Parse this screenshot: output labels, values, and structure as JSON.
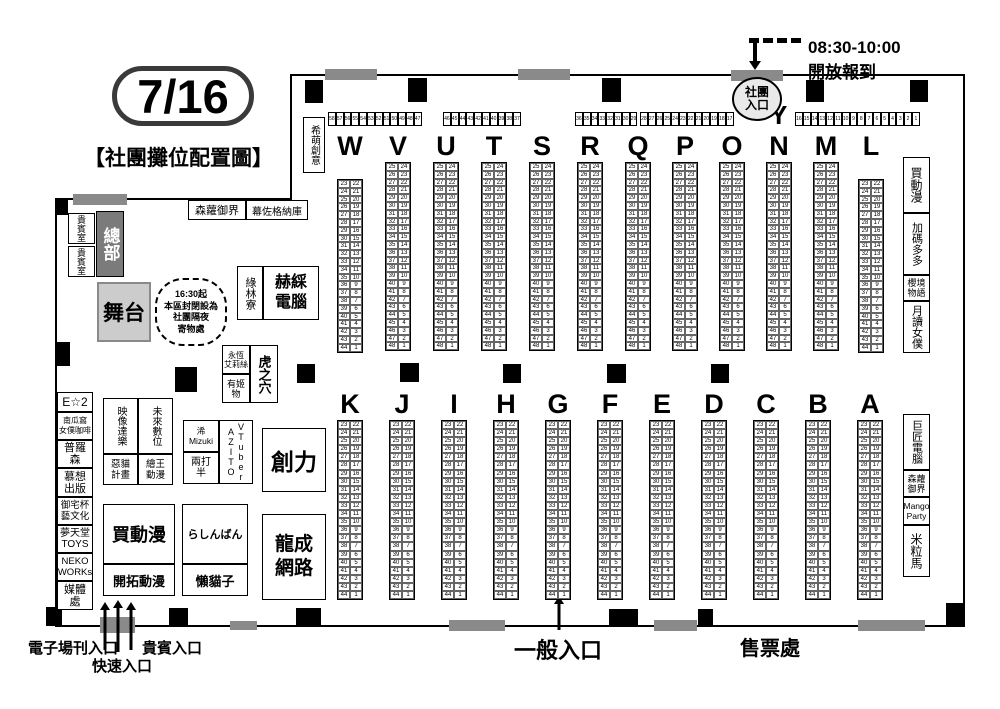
{
  "header": {
    "date": "7/16",
    "title": "【社團攤位配置圖】"
  },
  "notices": {
    "checkin_time": "08:30-10:00",
    "checkin_text": "開放報到"
  },
  "entrances": {
    "club": "社團\n入口",
    "general": "一般入口",
    "fast": "快速入口",
    "vip": "貴賓入口",
    "ezine": "電子場刊入口",
    "ticket": "售票處"
  },
  "booths": {
    "y_row": {
      "label": "Y",
      "segments": [
        {
          "from": 58,
          "to": 47
        },
        {
          "from": 46,
          "to": 37
        },
        {
          "from": 36,
          "to": 29
        },
        {
          "from": 28,
          "to": 17
        },
        {
          "from": 16,
          "to": 1
        }
      ]
    },
    "top_rows": [
      {
        "letter": "W",
        "left_from": 23,
        "left_to": 44,
        "right_from": 22
      },
      {
        "letter": "V",
        "left_from": 25,
        "left_to": 48,
        "right_from": 24
      },
      {
        "letter": "U",
        "left_from": 25,
        "left_to": 48,
        "right_from": 24
      },
      {
        "letter": "T",
        "left_from": 25,
        "left_to": 48,
        "right_from": 24
      },
      {
        "letter": "S",
        "left_from": 25,
        "left_to": 48,
        "right_from": 24
      },
      {
        "letter": "R",
        "left_from": 25,
        "left_to": 48,
        "right_from": 24
      },
      {
        "letter": "Q",
        "left_from": 25,
        "left_to": 48,
        "right_from": 24
      },
      {
        "letter": "P",
        "left_from": 25,
        "left_to": 48,
        "right_from": 24
      },
      {
        "letter": "O",
        "left_from": 25,
        "left_to": 48,
        "right_from": 24
      },
      {
        "letter": "N",
        "left_from": 25,
        "left_to": 48,
        "right_from": 24
      },
      {
        "letter": "M",
        "left_from": 25,
        "left_to": 48,
        "right_from": 24
      },
      {
        "letter": "L",
        "left_from": 23,
        "left_to": 44,
        "right_from": 22
      }
    ],
    "bottom_rows": [
      {
        "letter": "K",
        "left_from": 23,
        "left_to": 44,
        "right_from": 22
      },
      {
        "letter": "J",
        "left_from": 23,
        "left_to": 44,
        "right_from": 22
      },
      {
        "letter": "I",
        "left_from": 23,
        "left_to": 44,
        "right_from": 22
      },
      {
        "letter": "H",
        "left_from": 23,
        "left_to": 44,
        "right_from": 22
      },
      {
        "letter": "G",
        "left_from": 23,
        "left_to": 44,
        "right_from": 22
      },
      {
        "letter": "F",
        "left_from": 23,
        "left_to": 44,
        "right_from": 22
      },
      {
        "letter": "E",
        "left_from": 23,
        "left_to": 44,
        "right_from": 22
      },
      {
        "letter": "D",
        "left_from": 23,
        "left_to": 44,
        "right_from": 22
      },
      {
        "letter": "C",
        "left_from": 23,
        "left_to": 44,
        "right_from": 22
      },
      {
        "letter": "B",
        "left_from": 23,
        "left_to": 44,
        "right_from": 22
      },
      {
        "letter": "A",
        "left_from": 23,
        "left_to": 44,
        "right_from": 22
      }
    ]
  },
  "areas": {
    "ximeng": "希萌創意",
    "upper_booth_1": "森蘿御界",
    "upper_booth_2": "幕佐格納庫",
    "hq": "總部",
    "vip_room_1": "貴賓室",
    "vip_room_2": "貴賓室",
    "stage": "舞台",
    "closure_note": "16:30起\n本區封閉設為\n社團隔夜\n寄物處",
    "green_forest": "綠林寮",
    "hesai_pc": "赫綵\n電腦",
    "eternal_alice": "永恆\n艾莉絲",
    "youji": "有姬\n物",
    "toranoana": "虎之穴",
    "left_strip": {
      "e2": "E☆2",
      "pumpkin": "南瓜窩\n女僕咖啡",
      "puluosen": "普羅\n森",
      "muxiang": "慕想\n出版",
      "otaku_art": "御宅杯\n藝文化",
      "dreamland": "夢天堂\nTOYS",
      "neko_works": "NEKO\nWORKs",
      "media": "媒體\n處"
    },
    "mid_box1": {
      "video": "映像達樂",
      "future_digi": "未來數位",
      "evil_cat": "惡貓\n計畫",
      "huion": "繪王\n動漫"
    },
    "mid_box2": {
      "mizuki": "浠\nMizuki",
      "two_half": "兩打\n半",
      "vtuber": "VTuber\nAZITO"
    },
    "chuangli": "創力",
    "longcheng": "龍成\n網路",
    "buy_anime": "買動漫",
    "kaituo": "開拓動漫",
    "lashinbang": "らしんばん",
    "lazy_cat": "懶貓子",
    "right_strip_top": {
      "buy_anime": "買動漫",
      "jiama": "加碼多多",
      "sakura_story": "櫻境\n物語",
      "moon_maid": "月讀女僕"
    },
    "right_strip_bottom": {
      "giant_pc": "巨匠電腦",
      "senluo": "森蘿\n御界",
      "mango_party": "Mango\nParty",
      "rice_horse": "米粒馬"
    }
  }
}
